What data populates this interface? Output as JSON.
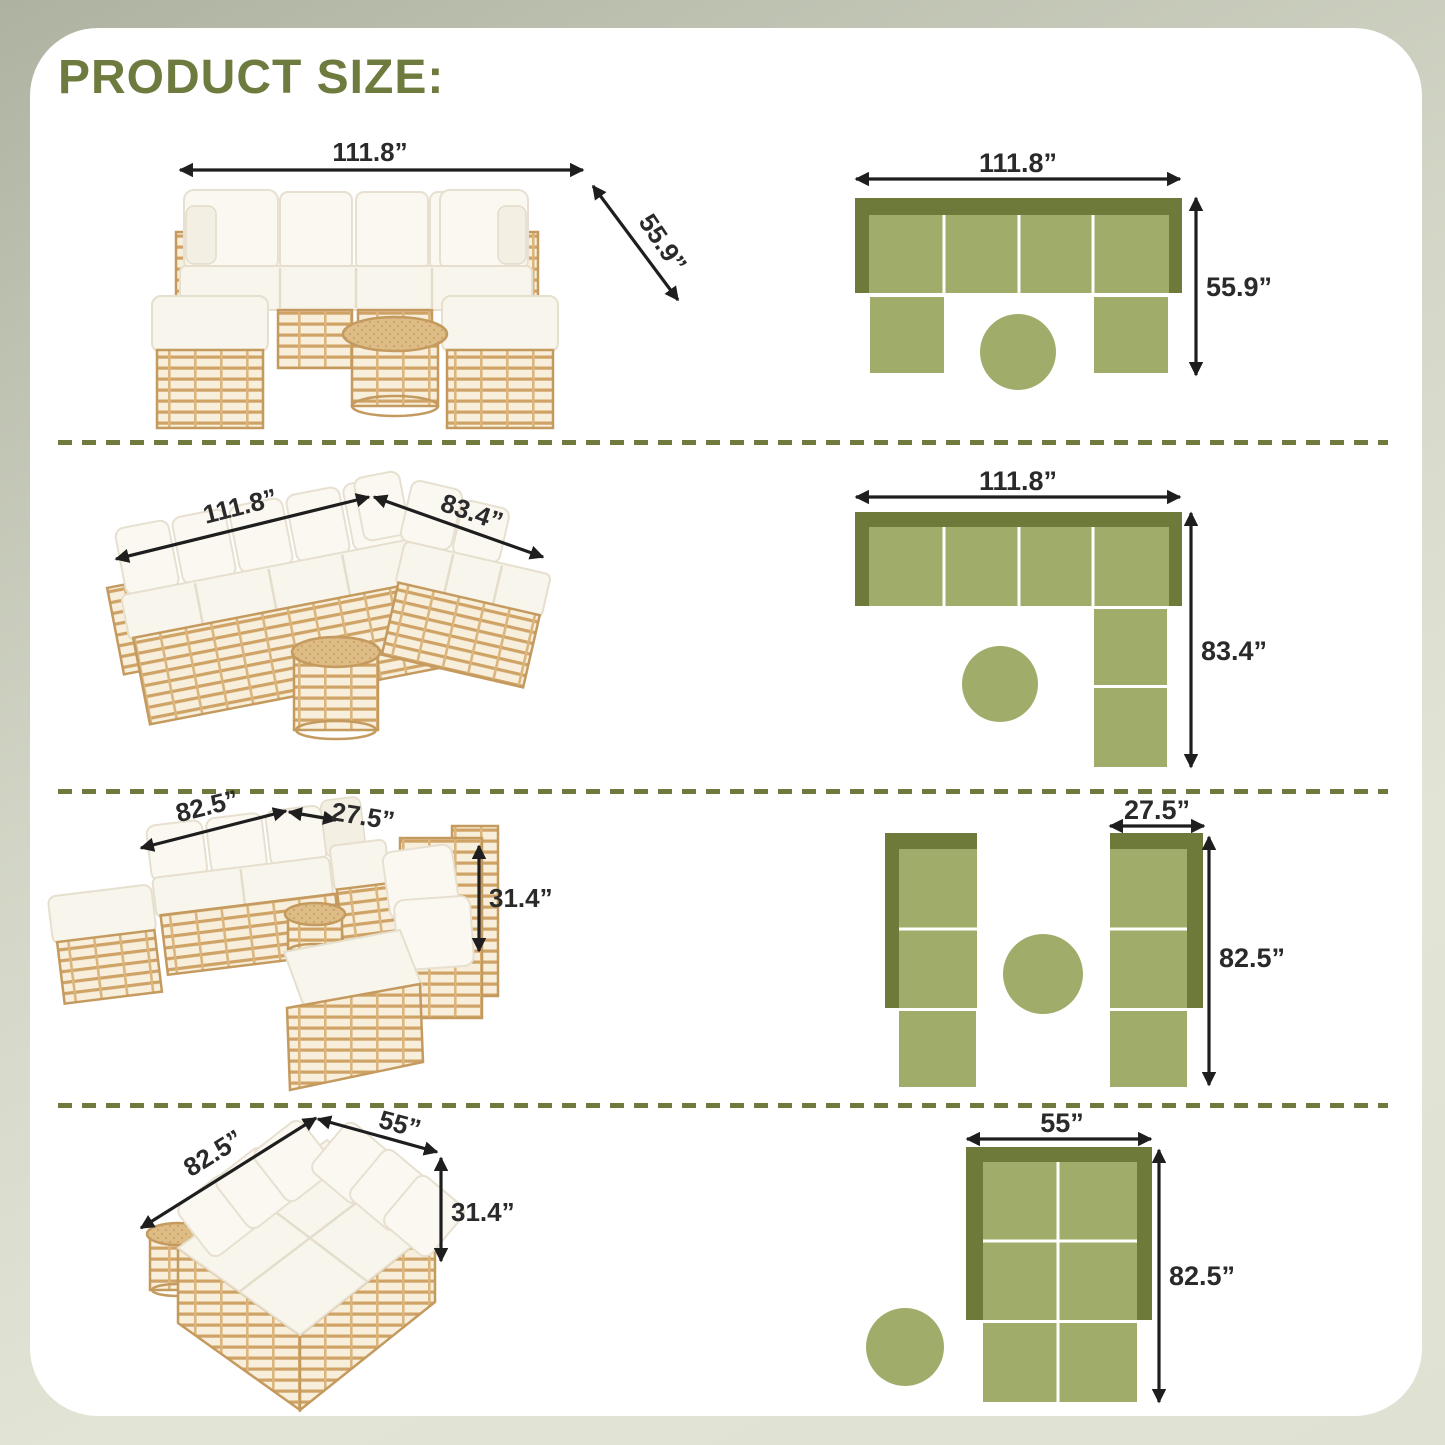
{
  "title": "PRODUCT SIZE:",
  "rows": [
    {
      "photo": {
        "width": "111.8”",
        "depth": "55.9”"
      },
      "diagram": {
        "width": "111.8”",
        "depth": "55.9”"
      }
    },
    {
      "photo": {
        "width": "111.8”",
        "depth": "83.4”"
      },
      "diagram": {
        "width": "111.8”",
        "depth": "83.4”"
      }
    },
    {
      "photo": {
        "width": "82.5”",
        "depth": "27.5”",
        "height": "31.4”"
      },
      "diagram": {
        "width": "27.5”",
        "depth": "82.5”"
      }
    },
    {
      "photo": {
        "width": "82.5”",
        "depth": "55”",
        "height": "31.4”"
      },
      "diagram": {
        "width": "55”",
        "depth": "82.5”"
      }
    }
  ],
  "colors": {
    "background": "#e1e3d5",
    "background_corner": "#b4b8a7",
    "card": "#ffffff",
    "title": "#6e7b3f",
    "divider_dash": "#6f7a3d",
    "diagram_dark_green": "#6d7a3a",
    "diagram_light_green": "#a0ad6a",
    "dimension_text": "#2a2a2a",
    "rattan": "#cfa265",
    "cushion": "#f8f5ec"
  }
}
